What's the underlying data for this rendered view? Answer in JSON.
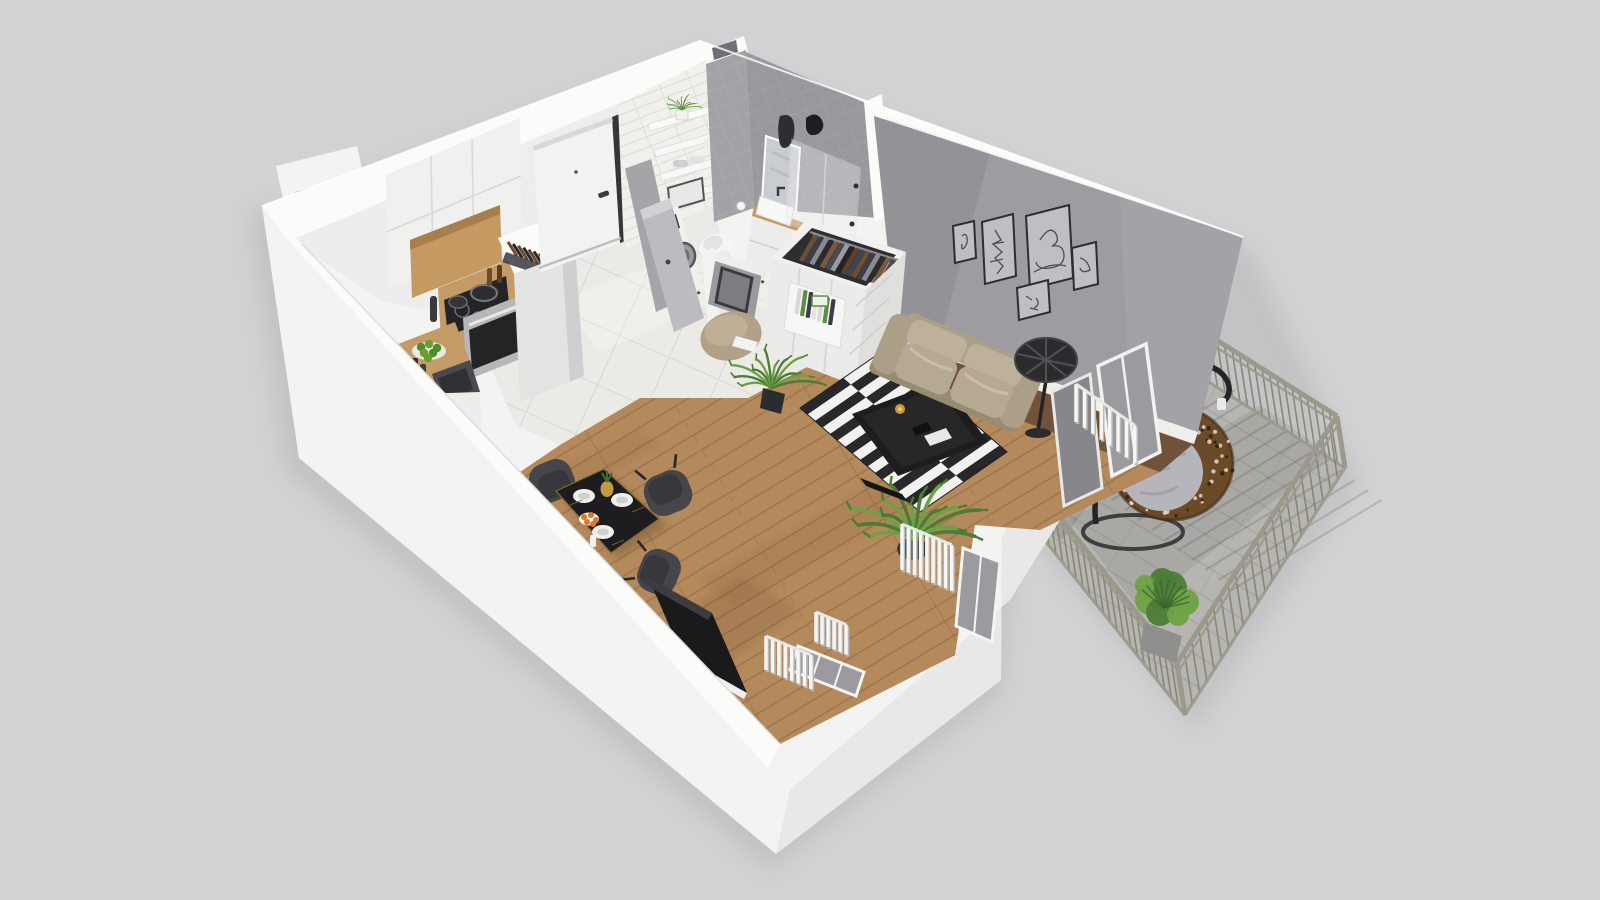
{
  "scene": {
    "type": "isometric-3d-floorplan-render",
    "rooms": [
      "kitchen",
      "hallway",
      "bathroom",
      "living-room",
      "dining-area",
      "balcony"
    ],
    "objects": [
      "kitchen-cabinets",
      "cooktop",
      "oven",
      "kitchen-island-sink",
      "knife-block",
      "entry-door",
      "bathroom-shelves",
      "toilet",
      "washing-machine",
      "vanity-sink",
      "mirror",
      "shower",
      "wardrobe-open-clothes",
      "bookshelf",
      "pouf",
      "console-mirror",
      "dining-table",
      "dining-chairs",
      "striped-rug",
      "coffee-table",
      "sofa",
      "floor-lamp",
      "wall-art-frames",
      "tv-panel",
      "radiators",
      "balcony-railing",
      "hanging-egg-chair",
      "balcony-plant",
      "potted-palms"
    ]
  },
  "colors": {
    "background": "#d2d2d4",
    "wallWhite": "#f3f3f1",
    "wallBright": "#fbfbf9",
    "wallShade": "#e4e4e2",
    "innerFace": "#ededeb",
    "outerShade": "#e9e8e6",
    "accentWall": "#9d9da1",
    "accentWallDark": "#8b8b8f",
    "subway": "#f1f0ec",
    "subwaySeam": "#dcdbd5",
    "grayTile": "#a3a3a7",
    "grayTileSeam": "#b2b2b6",
    "floorTile": "#eceae6",
    "floorTileSeam": "#d7d5d1",
    "bathFloor": "#efeee9",
    "wood": "#b4895b",
    "woodDark": "#6f5239",
    "woodSeam": "#86603e",
    "rugBlack": "#28282a",
    "rugWhite": "#f1f1ef",
    "sofaBase": "#ab9f87",
    "sofaLight": "#bdb19b",
    "sofaMid": "#b5a991",
    "sofaDark": "#978b74",
    "lampBlack": "#2b2b2d",
    "tableBlack": "#1d1d1f",
    "tableTrim": "#9a7a38",
    "chair": "#46464a",
    "chairDark": "#38383c",
    "doorWhite": "#f2f2f0",
    "trimDark": "#35353a",
    "steel": "#b7b7b9",
    "ovenGlass": "#242426",
    "cabinetWood": "#c59a62",
    "counterWood": "#c49a66",
    "plantGreen": "#4c7c36",
    "plantLight": "#6da244",
    "apple": "#67a02c",
    "orange": "#e07722",
    "pineapple": "#c89a40",
    "balconyFloor": "#b6b5b1",
    "balconySeam": "#a3a29e",
    "railing": "#9a998b",
    "railingDark": "#83826f",
    "rattan": "#6b4a28",
    "rattanDark": "#4a3118",
    "cushion": "#b6b6ba",
    "cushionShade": "#9e9ea4",
    "glass": "#9b9b9f",
    "glassDark": "#86868b",
    "black": "#26262a",
    "pouf": "#b2a188",
    "clothes": [
      "#6b4f35",
      "#3e3e46",
      "#8a8a92",
      "#2a2a30",
      "#7a5a3e",
      "#4a4a52",
      "#9a9aa0",
      "#23232a",
      "#5c4330",
      "#44444c"
    ],
    "books": [
      "#d8d8d4",
      "#5a8f45",
      "#3c3c44",
      "#e4e4e0"
    ]
  }
}
